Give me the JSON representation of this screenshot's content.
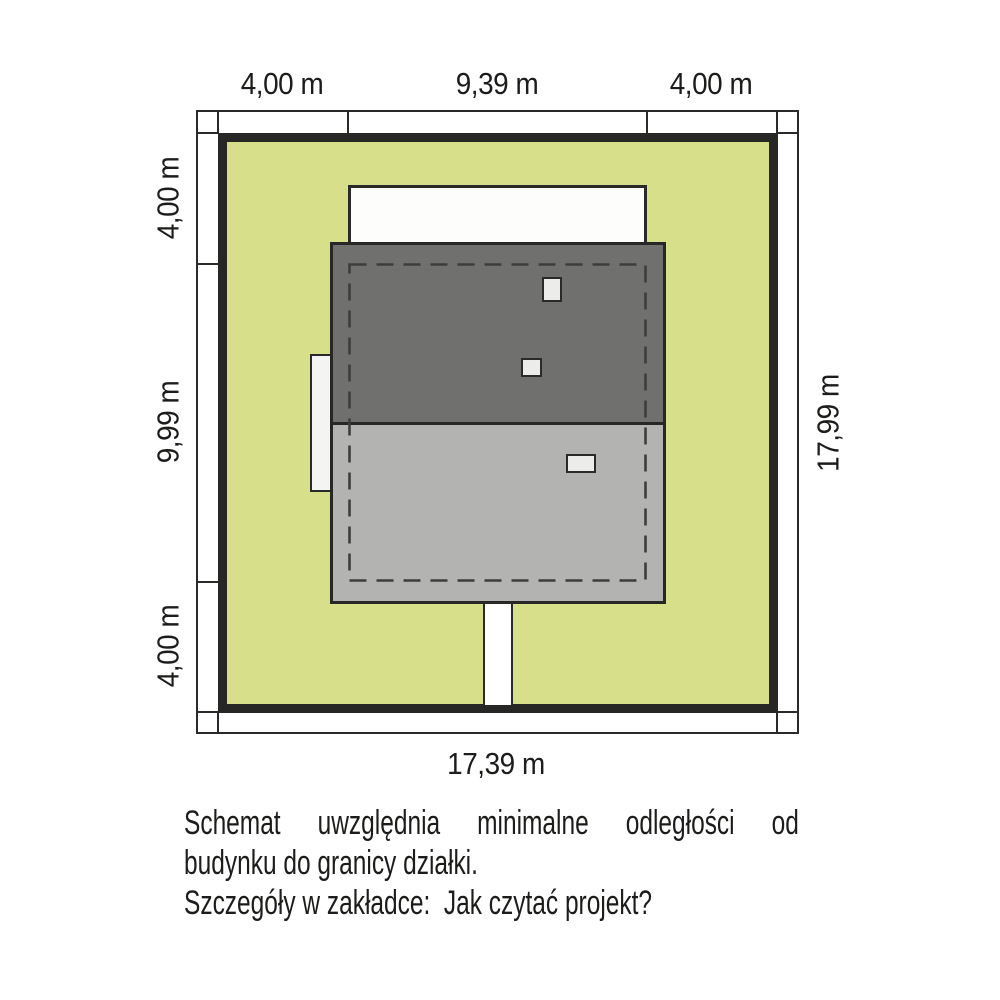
{
  "site_plan": {
    "dimensions": {
      "top_left": "4,00 m",
      "top_center": "9,39 m",
      "top_right": "4,00 m",
      "left_top": "4,00 m",
      "left_middle": "9,99 m",
      "left_bottom": "4,00 m",
      "right_full": "17,99 m",
      "bottom_full": "17,39 m"
    },
    "notes": {
      "line1": "Schemat uwzględnia minimalne odległości od",
      "line2": "budynku do granicy działki.",
      "line3": "Szczegóły w zakładce:  Jak czytać projekt?"
    },
    "colors": {
      "plot_green": "#d8df8b",
      "roof_dark_gray": "#70716f",
      "roof_light_gray": "#b3b4b2",
      "line_dark": "#2a2a28",
      "opening_white": "#ececea",
      "text": "#1c1c1a"
    }
  }
}
